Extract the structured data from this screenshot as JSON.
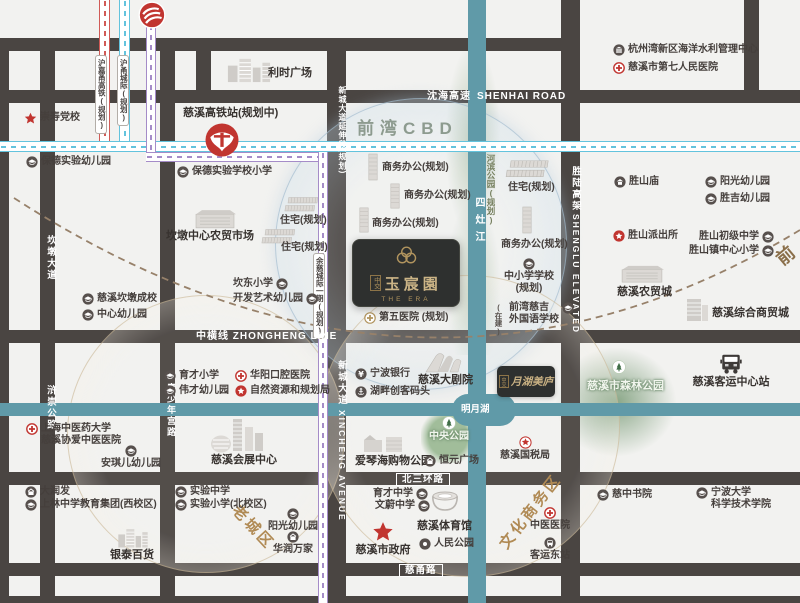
{
  "project": {
    "brand": "中交",
    "name": "玉宸園",
    "en": "THE ERA"
  },
  "sister": {
    "brand": "中交",
    "name": "月湖美庐"
  },
  "zones": {
    "cbd": "前湾CBD",
    "old_town": "老城区",
    "culture_biz": "文化商务区",
    "qianwan_line": "前"
  },
  "roads": {
    "shenhai_cn": "沈海高速",
    "shenhai_en": "SHENHAI ROAD",
    "zhongheng": "中横线  ZHONGHENG LINE",
    "beisanhuan": "北三环路",
    "ciyong": "慈甬路",
    "xincheng_ext": "新城大道延伸段(规划)",
    "xincheng_cn": "新城大道",
    "xincheng_en": "XINCHENG AVENUE",
    "shenglu_cn": "胜陆高架",
    "shenglu_en": "SHENGLU ELEVATED",
    "kandun": "坎墩大道",
    "huchong": "浒崇公路",
    "qingshaonian": "青少年宫路"
  },
  "rails": {
    "hujiayong": "沪嘉甬高铁(规划)",
    "huyong": "沪甬城际(规划)",
    "yuci": "余慈城际一期(规划)"
  },
  "waters": {
    "sizao": "四灶江",
    "mingyue": "明月湖",
    "riverside_park": "河滨公园(规划)"
  },
  "pois": [
    {
      "id": "chongshou-party-school",
      "label": "崇寿党校",
      "icon": "star",
      "x": 24,
      "y": 112
    },
    {
      "id": "lishi-plaza",
      "label": "利时广场",
      "icon": "",
      "x": 268,
      "y": 67,
      "big": true
    },
    {
      "id": "baode-exp-kindergarten",
      "label": "保德实验幼儿园",
      "icon": "school",
      "x": 26,
      "y": 156
    },
    {
      "id": "cixi-hsr-station",
      "label": "慈溪高铁站(规划中)",
      "icon": "",
      "x": 183,
      "y": 107,
      "big": true
    },
    {
      "id": "baode-exp-primary",
      "label": "保德实验学校小学",
      "icon": "school",
      "x": 177,
      "y": 166
    },
    {
      "id": "hzw-water-center",
      "label": "杭州湾新区海洋水利管理中心",
      "icon": "office",
      "x": 613,
      "y": 44
    },
    {
      "id": "no7-people-hospital",
      "label": "慈溪市第七人民医院",
      "icon": "hospital",
      "x": 613,
      "y": 62
    },
    {
      "id": "biz-office-1",
      "label": "商务办公(规划)",
      "icon": "",
      "x": 382,
      "y": 162
    },
    {
      "id": "biz-office-2",
      "label": "商务办公(规划)",
      "icon": "",
      "x": 404,
      "y": 190
    },
    {
      "id": "biz-office-3",
      "label": "商务办公(规划)",
      "icon": "",
      "x": 372,
      "y": 218
    },
    {
      "id": "residential-1",
      "label": "住宅(规划)",
      "icon": "",
      "x": 280,
      "y": 215
    },
    {
      "id": "residential-2",
      "label": "住宅(规划)",
      "icon": "",
      "x": 281,
      "y": 242
    },
    {
      "id": "kandun-farmers-market",
      "label": "坎墩中心农贸市场",
      "icon": "",
      "x": 166,
      "y": 230,
      "big": true
    },
    {
      "id": "kandong-primary",
      "label": "坎东小学",
      "icon": "school",
      "x": 233,
      "y": 278,
      "iconRight": true
    },
    {
      "id": "kaifa-art-kindergarten",
      "label": "开发艺术幼儿园",
      "icon": "school",
      "x": 233,
      "y": 293,
      "iconRight": true
    },
    {
      "id": "cixi-kandun-school",
      "label": "慈溪坎墩成校",
      "icon": "school",
      "x": 82,
      "y": 293
    },
    {
      "id": "center-kindergarten",
      "label": "中心幼儿园",
      "icon": "school",
      "x": 82,
      "y": 309
    },
    {
      "id": "residential-3",
      "label": "住宅(规划)",
      "icon": "",
      "x": 508,
      "y": 182
    },
    {
      "id": "biz-office-4",
      "label": "商务办公(规划)",
      "icon": "",
      "x": 501,
      "y": 239
    },
    {
      "id": "primary-middle-planned",
      "label": "中小学学校",
      "label2": "(规划)",
      "icon": "school",
      "x": 501,
      "y": 258,
      "stack": true,
      "w": 56
    },
    {
      "id": "under-construction-tag",
      "label": "(在建)",
      "icon": "",
      "x": 494,
      "y": 303,
      "vert": true
    },
    {
      "id": "qianwan-ciji-school",
      "label": "前湾慈吉",
      "label2": "外国语学校",
      "icon": "school",
      "x": 509,
      "y": 302,
      "iconRight": true
    },
    {
      "id": "no5-hospital-planned",
      "label": "第五医院 (规划)",
      "icon": "goldcross",
      "x": 364,
      "y": 312
    },
    {
      "id": "shengshan-temple",
      "label": "胜山庙",
      "icon": "temple",
      "x": 614,
      "y": 176
    },
    {
      "id": "yangguang-kindergarten-n",
      "label": "阳光幼儿园",
      "icon": "school",
      "x": 705,
      "y": 176
    },
    {
      "id": "shengji-kindergarten",
      "label": "胜吉幼儿园",
      "icon": "school",
      "x": 705,
      "y": 193
    },
    {
      "id": "shengshan-police",
      "label": "胜山派出所",
      "icon": "police",
      "x": 613,
      "y": 230
    },
    {
      "id": "shengshan-junior-middle",
      "label": "胜山初级中学",
      "icon": "school",
      "x": 699,
      "y": 231,
      "iconRight": true
    },
    {
      "id": "shengshan-central-primary",
      "label": "胜山镇中心小学",
      "icon": "school",
      "x": 689,
      "y": 245,
      "iconRight": true
    },
    {
      "id": "cixi-agri-trade-city",
      "label": "慈溪农贸城",
      "icon": "",
      "x": 617,
      "y": 286,
      "big": true
    },
    {
      "id": "cixi-comprehensive-trade-city",
      "label": "慈溪综合商贸城",
      "icon": "",
      "x": 712,
      "y": 307,
      "big": true
    },
    {
      "id": "shanghai-tcm-hospital",
      "label": "上海中医药大学",
      "label2": "慈溪协爱中医医院",
      "icon": "hospital",
      "x": 26,
      "y": 423
    },
    {
      "id": "angel-kindergarten",
      "label": "安琪儿幼儿园",
      "icon": "school",
      "x": 100,
      "y": 445,
      "stack": true,
      "w": 62
    },
    {
      "id": "yucai-primary",
      "label": "育才小学",
      "icon": "school",
      "x": 164,
      "y": 370
    },
    {
      "id": "weicai-kindergarten",
      "label": "伟才幼儿园",
      "icon": "school",
      "x": 164,
      "y": 385
    },
    {
      "id": "huayang-dental-hospital",
      "label": "华阳口腔医院",
      "icon": "hospital",
      "x": 235,
      "y": 370
    },
    {
      "id": "natural-resources-bureau",
      "label": "自然资源和规划局",
      "icon": "police",
      "x": 235,
      "y": 385
    },
    {
      "id": "cixi-convention-center",
      "label": "慈溪会展中心",
      "icon": "",
      "x": 211,
      "y": 454,
      "big": true
    },
    {
      "id": "ningbo-bank",
      "label": "宁波银行",
      "icon": "bank",
      "x": 355,
      "y": 368
    },
    {
      "id": "lakeside-maker-wharf",
      "label": "湖畔创客码头",
      "icon": "wharf",
      "x": 355,
      "y": 386
    },
    {
      "id": "cixi-grand-theater",
      "label": "慈溪大剧院",
      "icon": "",
      "x": 418,
      "y": 374,
      "big": true
    },
    {
      "id": "aegean-shopping-park",
      "label": "爱琴海购物公园",
      "icon": "",
      "x": 355,
      "y": 455,
      "big": true
    },
    {
      "id": "hengyuan-plaza",
      "label": "恒元广场",
      "icon": "shop",
      "x": 424,
      "y": 455
    },
    {
      "id": "central-park",
      "label": "中央公园",
      "icon": "tree",
      "x": 424,
      "y": 416,
      "stack": true,
      "w": 50,
      "light": true
    },
    {
      "id": "forest-park-tree",
      "label": "",
      "icon": "tree",
      "x": 612,
      "y": 360
    },
    {
      "id": "cixi-forest-park",
      "label": "慈溪市森林公园",
      "icon": "",
      "x": 587,
      "y": 380,
      "big": true,
      "light": true
    },
    {
      "id": "cixi-passenger-center",
      "label": "慈溪客运中心站",
      "icon": "truck",
      "x": 688,
      "y": 353,
      "stack": true,
      "w": 86,
      "big": true
    },
    {
      "id": "cixi-tax-bureau",
      "label": "慈溪国税局",
      "icon": "taxstar",
      "x": 494,
      "y": 436,
      "stack": true,
      "w": 62
    },
    {
      "id": "darunfa",
      "label": "大润发",
      "icon": "shop",
      "x": 25,
      "y": 486
    },
    {
      "id": "shanglin-middle-west",
      "label": "上林中学教育集团(西校区)",
      "icon": "school",
      "x": 25,
      "y": 499
    },
    {
      "id": "shiyan-middle",
      "label": "实验中学",
      "icon": "school",
      "x": 175,
      "y": 486
    },
    {
      "id": "shiyan-primary-north",
      "label": "实验小学(北校区)",
      "icon": "school",
      "x": 175,
      "y": 499
    },
    {
      "id": "yintai-department-store",
      "label": "银泰百货",
      "icon": "",
      "x": 110,
      "y": 549,
      "big": true
    },
    {
      "id": "yangguang-kindergarten-s",
      "label": "阳光幼儿园",
      "icon": "school",
      "x": 264,
      "y": 508,
      "stack": true,
      "w": 58
    },
    {
      "id": "huarun-wanjia",
      "label": "华润万家",
      "icon": "shop",
      "x": 264,
      "y": 531,
      "stack": true,
      "w": 58
    },
    {
      "id": "yucai-middle",
      "label": "育才中学",
      "icon": "school",
      "x": 373,
      "y": 488,
      "iconRight": true
    },
    {
      "id": "wenwei-middle",
      "label": "文蔚中学",
      "icon": "school",
      "x": 375,
      "y": 500,
      "iconRight": true
    },
    {
      "id": "cixi-stadium",
      "label": "慈溪体育馆",
      "icon": "",
      "x": 417,
      "y": 520,
      "big": true
    },
    {
      "id": "renmin-park",
      "label": "人民公园",
      "icon": "dot",
      "x": 419,
      "y": 538
    },
    {
      "id": "cixi-city-government",
      "label": "慈溪市政府",
      "icon": "bigstar",
      "x": 346,
      "y": 521,
      "stack": true,
      "w": 74,
      "big": true
    },
    {
      "id": "tcm-hospital",
      "label": "中医医院",
      "icon": "hospital",
      "x": 522,
      "y": 507,
      "stack": true,
      "w": 56
    },
    {
      "id": "east-bus-station",
      "label": "客运东站",
      "icon": "bus",
      "x": 521,
      "y": 537,
      "stack": true,
      "w": 58
    },
    {
      "id": "cizhong-academy",
      "label": "慈中书院",
      "icon": "school",
      "x": 597,
      "y": 489
    },
    {
      "id": "nbu-sci-tech-college",
      "label": "宁波大学",
      "label2": "科学技术学院",
      "icon": "school",
      "x": 696,
      "y": 487
    }
  ],
  "decos": [
    {
      "type": "building",
      "name": "lishi-plaza-building",
      "x": 226,
      "y": 55,
      "w": 46,
      "h": 29
    },
    {
      "type": "market",
      "name": "kandun-market-building",
      "x": 194,
      "y": 208,
      "w": 42,
      "h": 23
    },
    {
      "type": "tower",
      "name": "office-tower-1",
      "x": 366,
      "y": 152,
      "w": 14,
      "h": 30
    },
    {
      "type": "tower",
      "name": "office-tower-2",
      "x": 388,
      "y": 182,
      "w": 14,
      "h": 28
    },
    {
      "type": "tower",
      "name": "office-tower-3",
      "x": 357,
      "y": 206,
      "w": 14,
      "h": 28
    },
    {
      "type": "housing",
      "name": "housing-rows-1",
      "x": 284,
      "y": 196,
      "w": 36,
      "h": 17
    },
    {
      "type": "housing",
      "name": "housing-rows-2",
      "x": 261,
      "y": 228,
      "w": 36,
      "h": 17
    },
    {
      "type": "housing",
      "name": "housing-rows-3",
      "x": 505,
      "y": 159,
      "w": 46,
      "h": 20
    },
    {
      "type": "tower",
      "name": "office-tower-4",
      "x": 520,
      "y": 205,
      "w": 14,
      "h": 30
    },
    {
      "type": "convention",
      "name": "convention-center-building",
      "x": 209,
      "y": 415,
      "w": 56,
      "h": 40
    },
    {
      "type": "theater",
      "name": "grand-theater-building",
      "x": 422,
      "y": 350,
      "w": 46,
      "h": 25
    },
    {
      "type": "mall",
      "name": "aegean-mall-building",
      "x": 362,
      "y": 432,
      "w": 44,
      "h": 22
    },
    {
      "type": "building",
      "name": "yintai-building",
      "x": 117,
      "y": 526,
      "w": 32,
      "h": 23
    },
    {
      "type": "market",
      "name": "agri-city-building",
      "x": 620,
      "y": 264,
      "w": 44,
      "h": 21
    },
    {
      "type": "tower2",
      "name": "trade-city-building",
      "x": 683,
      "y": 297,
      "w": 28,
      "h": 26
    },
    {
      "type": "stadium",
      "name": "stadium-building",
      "x": 429,
      "y": 488,
      "w": 32,
      "h": 30
    }
  ]
}
